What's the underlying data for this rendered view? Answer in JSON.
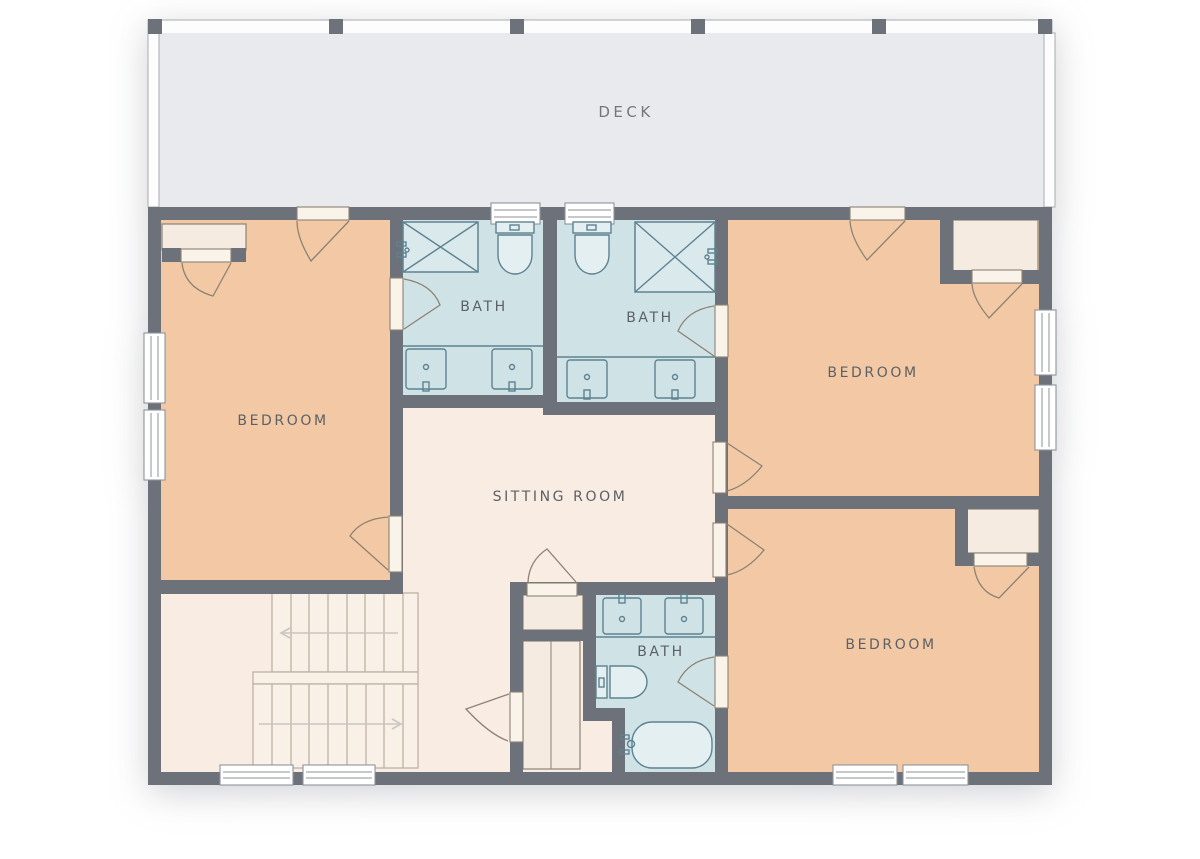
{
  "floorplan": {
    "rooms": {
      "deck": {
        "label": "DECK"
      },
      "bedroom_left": {
        "label": "BEDROOM"
      },
      "bedroom_top_right": {
        "label": "BEDROOM"
      },
      "bedroom_bottom_right": {
        "label": "BEDROOM"
      },
      "bath_top_left": {
        "label": "BATH"
      },
      "bath_top_right": {
        "label": "BATH"
      },
      "bath_bottom": {
        "label": "BATH"
      },
      "sitting_room": {
        "label": "SITTING ROOM"
      }
    },
    "colors": {
      "wall": "#6d727a",
      "bedroom_fill": "#f2c9a4",
      "bath_fill": "#cfe3e7",
      "floor_fill": "#f8ece3",
      "deck_fill": "#e9eaed",
      "closet_fill": "#f6ebe1",
      "label_text": "#5c6165",
      "fixture_line": "#5e8290",
      "fixture_fill": "#e3eff1",
      "door_line": "#8d8274",
      "door_panel": "#faf3ea",
      "stair_line": "#bcb2a5",
      "arrow_line": "#cac6c0",
      "window_border": "#8e939a",
      "rail_border": "#a7acb2"
    }
  }
}
